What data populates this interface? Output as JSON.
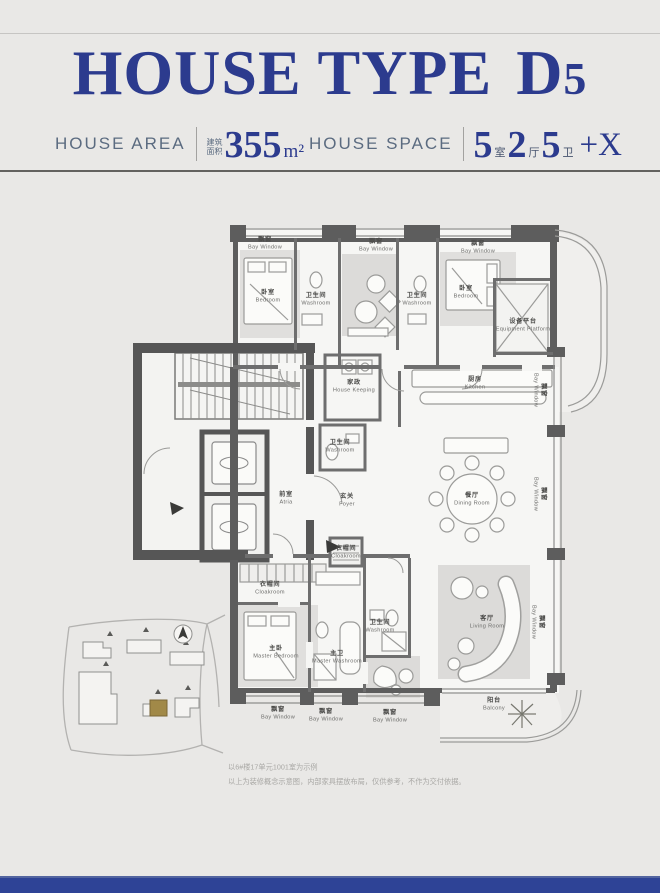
{
  "page": {
    "bg": "#e9e8e6",
    "accent_blue": "#2c3b8e",
    "footer_bar": "#2e4396"
  },
  "header": {
    "title": {
      "t1": "HOUSE TYPE",
      "t2": "D",
      "t3": "5"
    },
    "area": {
      "label": "HOUSE AREA",
      "cn_1": "建筑",
      "cn_2": "面积",
      "value": "355",
      "unit": "m²"
    },
    "space": {
      "label": "HOUSE SPACE",
      "parts": [
        {
          "num": "5",
          "unit": "室"
        },
        {
          "num": "2",
          "unit": "厅"
        },
        {
          "num": "5",
          "unit": "卫"
        }
      ],
      "suffix": "+X"
    }
  },
  "floor_plan": {
    "rooms": [
      {
        "id": "bw-top-1",
        "cn": "飘窗",
        "en": "Bay Window"
      },
      {
        "id": "bw-top-2",
        "cn": "飘窗",
        "en": "Bay Window"
      },
      {
        "id": "bw-top-3",
        "cn": "飘窗",
        "en": "Bay Window"
      },
      {
        "id": "bedroom-1",
        "cn": "卧室",
        "en": "Bedroom"
      },
      {
        "id": "washroom-1",
        "cn": "卫生间",
        "en": "Washroom"
      },
      {
        "id": "washroom-2",
        "cn": "卫生间",
        "en": "Washroom"
      },
      {
        "id": "bedroom-2",
        "cn": "卧室",
        "en": "Bedroom"
      },
      {
        "id": "equipment-platform",
        "cn": "设备平台",
        "en": "Equipment Platform"
      },
      {
        "id": "bw-right-1",
        "cn": "飘窗",
        "en": "Bay Window"
      },
      {
        "id": "kitchen",
        "cn": "厨房",
        "en": "Kitchen"
      },
      {
        "id": "house-keeping",
        "cn": "家政",
        "en": "House Keeping"
      },
      {
        "id": "washroom-3",
        "cn": "卫生间",
        "en": "Washroom"
      },
      {
        "id": "atria",
        "cn": "前室",
        "en": "Atria"
      },
      {
        "id": "foyer",
        "cn": "玄关",
        "en": "Foyer"
      },
      {
        "id": "dining-room",
        "cn": "餐厅",
        "en": "Dining Room"
      },
      {
        "id": "bw-right-2",
        "cn": "飘窗",
        "en": "Bay Window"
      },
      {
        "id": "cloakroom-1",
        "cn": "衣帽间",
        "en": "Cloakroom"
      },
      {
        "id": "cloakroom-2",
        "cn": "衣帽间",
        "en": "Cloakroom"
      },
      {
        "id": "master-bedroom",
        "cn": "主卧",
        "en": "Master Bedroom"
      },
      {
        "id": "master-washroom",
        "cn": "主卫",
        "en": "Master Washroom"
      },
      {
        "id": "washroom-4",
        "cn": "卫生间",
        "en": "Washroom"
      },
      {
        "id": "living-room",
        "cn": "客厅",
        "en": "Living Room"
      },
      {
        "id": "bw-right-3",
        "cn": "飘窗",
        "en": "Bay Window"
      },
      {
        "id": "balcony",
        "cn": "阳台",
        "en": "Balcony"
      },
      {
        "id": "bw-bottom-1",
        "cn": "飘窗",
        "en": "Bay Window"
      },
      {
        "id": "bw-bottom-2",
        "cn": "飘窗",
        "en": "Bay Window"
      },
      {
        "id": "bw-bottom-3",
        "cn": "飘窗",
        "en": "Bay Window"
      }
    ]
  },
  "notes": {
    "line1": "以6#楼17单元1001室为示例",
    "line2": "以上为装修概念示意图，内部家具摆放布局，仅供参考，不作为交付依据。"
  }
}
